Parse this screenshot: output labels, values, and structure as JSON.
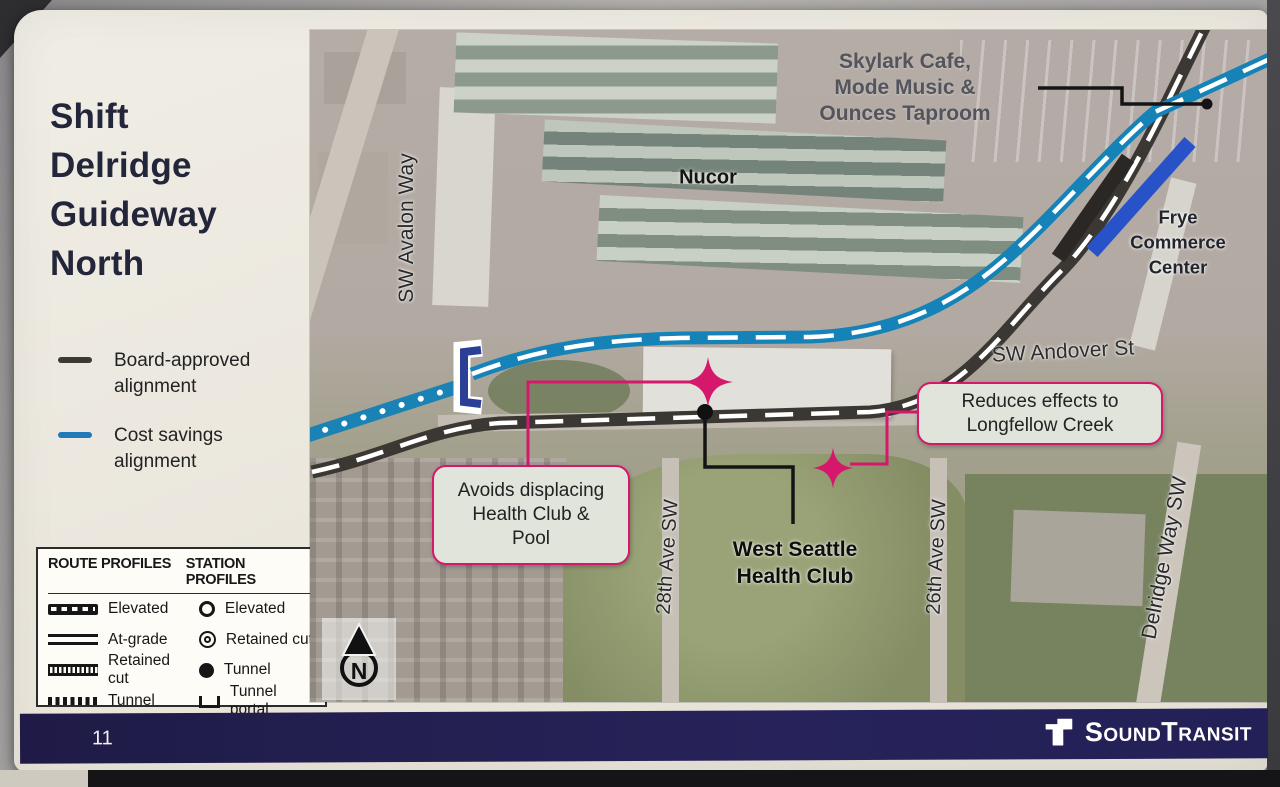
{
  "slide": {
    "title": "Shift\nDelridge\nGuideway\nNorth"
  },
  "legend": {
    "items": [
      {
        "label": "Board-approved alignment",
        "color": "#3f3933"
      },
      {
        "label": "Cost savings alignment",
        "color": "#2079b8"
      }
    ]
  },
  "profiles": {
    "route_header": "ROUTE PROFILES",
    "station_header": "STATION PROFILES",
    "route_items": [
      {
        "label": "Elevated"
      },
      {
        "label": "At-grade"
      },
      {
        "label": "Retained cut"
      },
      {
        "label": "Tunnel"
      }
    ],
    "station_items": [
      {
        "label": "Elevated"
      },
      {
        "label": "Retained cut"
      },
      {
        "label": "Tunnel"
      },
      {
        "label": "Tunnel portal"
      }
    ]
  },
  "map": {
    "place_labels": {
      "skylark": "Skylark Cafe,\nMode Music &\nOunces Taproom",
      "nucor": "Nucor",
      "frye": "Frye\nCommerce\nCenter",
      "health_club": "West Seattle\nHealth Club"
    },
    "street_labels": {
      "avalon": "SW Avalon Way",
      "andover": "SW Andover St",
      "ave_28": "28th Ave SW",
      "ave_26": "26th Ave SW",
      "delridge": "Delridge Way SW"
    },
    "callouts": [
      {
        "text": "Avoids displacing\nHealth Club &\nPool"
      },
      {
        "text": "Reduces effects to\nLongfellow Creek"
      }
    ],
    "north_label": "N",
    "colors": {
      "board_approved": "#3b3733",
      "cost_savings": "#1583b8",
      "cost_savings_solid": "#2853c8",
      "annotation_pink": "#d5186b"
    }
  },
  "footer": {
    "page_number": "11",
    "brand": "SoundTransit"
  }
}
